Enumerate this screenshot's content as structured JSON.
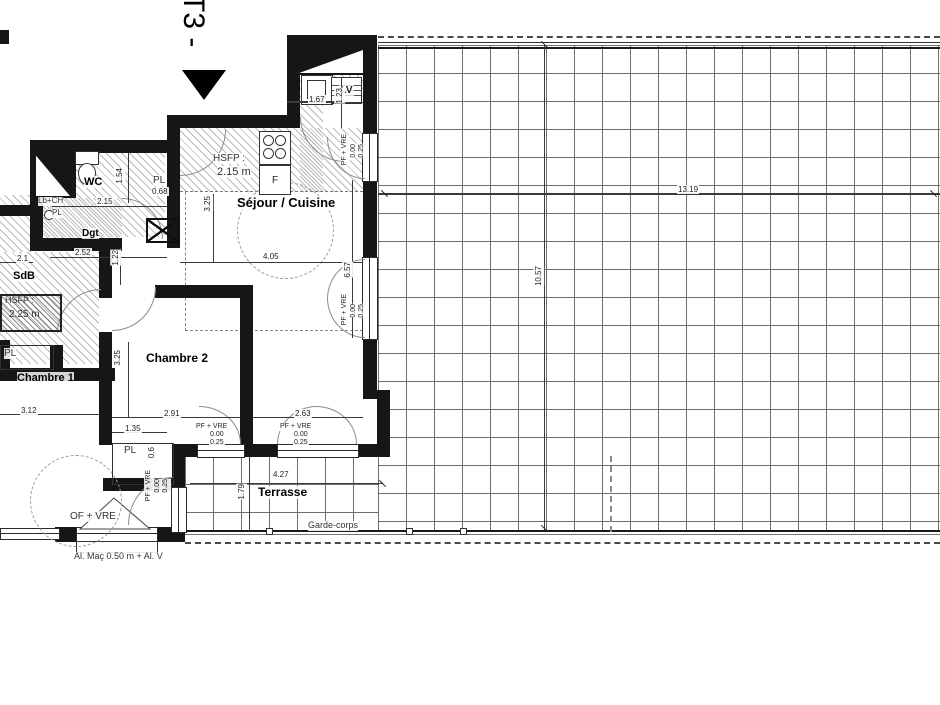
{
  "plan": {
    "type_label": "T3 -"
  },
  "rooms": {
    "wc": "WC",
    "dgt": "Dgt",
    "sdb": "SdB",
    "chambre1": "Chambre 1",
    "chambre2": "Chambre 2",
    "sejour": "Séjour / Cuisine",
    "terrasse": "Terrasse"
  },
  "ceiling": {
    "sejour_label": "HSFP :",
    "sejour_value": "2.15 m",
    "sdb_label": "HSFP :",
    "sdb_value": "2.25 m"
  },
  "fixtures": {
    "dishwasher": "LV",
    "oven": "F",
    "washbasin_heater": "Lb+CH",
    "closet": "PL",
    "closet_wc_width": "0.68",
    "closet_ch1_width": "0.6"
  },
  "openings": {
    "pf_vre": "PF + VRE",
    "of_vre": "OF + VRE",
    "sill_zero": "0.00",
    "sill_low": "0.25",
    "allege": "Al. Maç 0.50 m + Al. V",
    "garde_corps": "Garde-corps"
  },
  "dims": {
    "kitchen_counter_w": "1.67",
    "kitchen_counter_d": "1.23",
    "wc_w": "2.15",
    "wc_d": "1.54",
    "dgt_w": "2.52",
    "dgt_d": "1.22",
    "balcony_left": "2.1",
    "sejour_w": "4.05",
    "sejour_d": "3.25",
    "sejour_right": "6.57",
    "ch1_w": "3.12",
    "ch2_w": "2.91",
    "ch2_d": "3.25",
    "ch2_extra": "1.35",
    "sejour_lower_w": "2.63",
    "terrasse_w": "4.27",
    "terrasse_d": "1.79",
    "roof_w": "13.19",
    "roof_d": "10.57"
  }
}
